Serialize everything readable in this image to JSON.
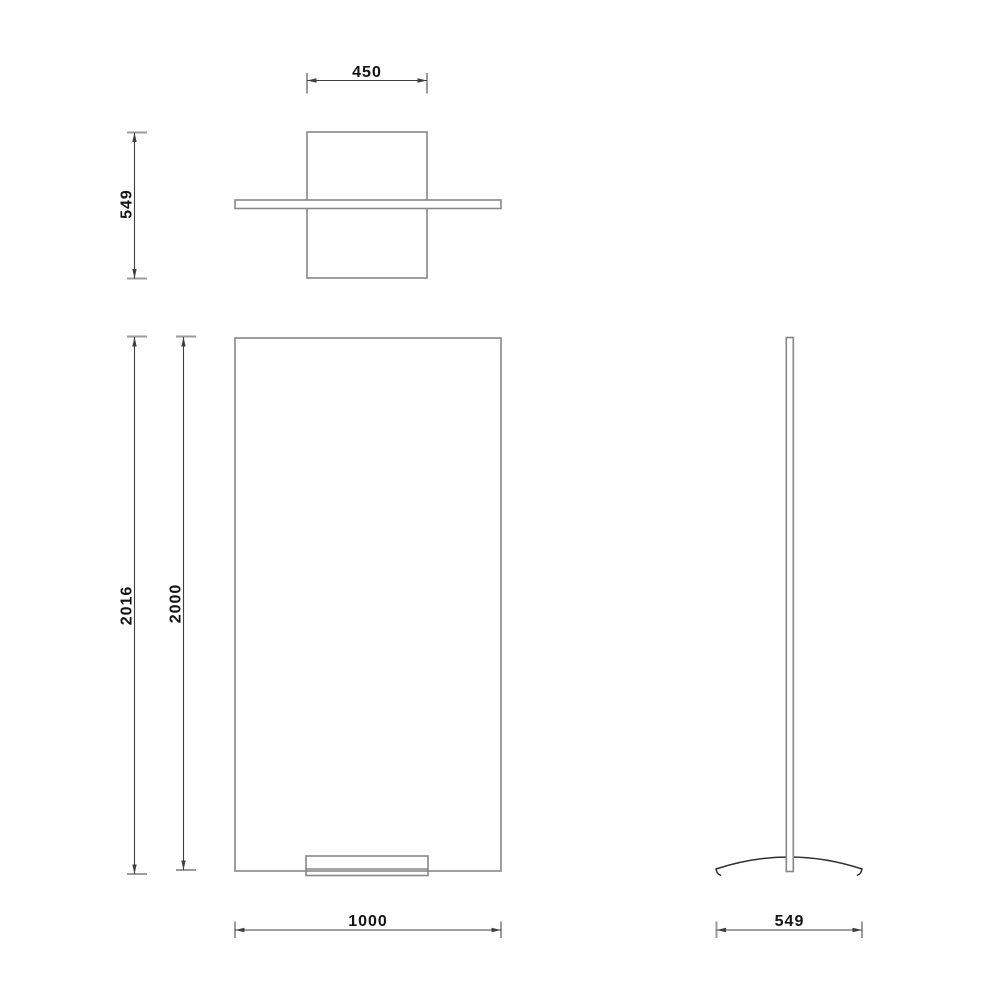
{
  "dimensions": {
    "top_view_width": "450",
    "top_view_depth": "549",
    "front_overall_height": "2016",
    "front_panel_height": "2000",
    "front_panel_width": "1000",
    "side_base_depth": "549"
  },
  "colors": {
    "background": "#ffffff",
    "object_outline": "#878787",
    "dimension_line": "#3f3f3f",
    "witness_tick": "#9c9c9c",
    "label_text": "#141414"
  }
}
